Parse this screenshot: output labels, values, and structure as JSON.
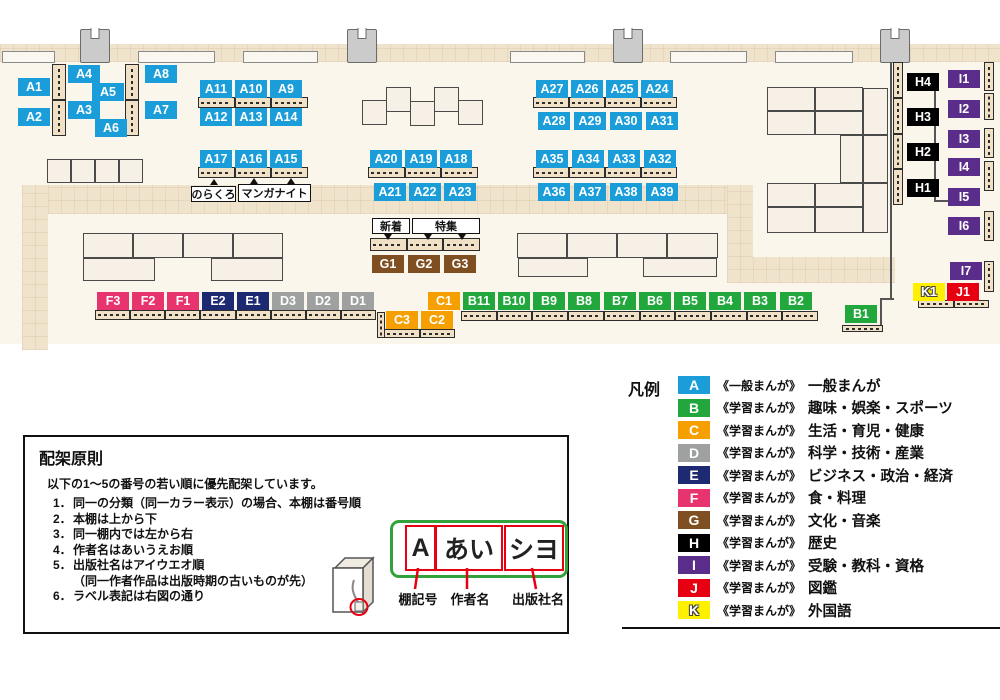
{
  "legend": {
    "title": "凡例",
    "items": [
      {
        "code": "A",
        "color": "#1B9DD9",
        "type": "《一般まんが》",
        "label": "一般まんが"
      },
      {
        "code": "B",
        "color": "#22A73D",
        "type": "《学習まんが》",
        "label": "趣味・娯楽・スポーツ"
      },
      {
        "code": "C",
        "color": "#F5A000",
        "type": "《学習まんが》",
        "label": "生活・育児・健康"
      },
      {
        "code": "D",
        "color": "#9FA0A0",
        "type": "《学習まんが》",
        "label": "科学・技術・産業"
      },
      {
        "code": "E",
        "color": "#1D2A72",
        "type": "《学習まんが》",
        "label": "ビジネス・政治・経済"
      },
      {
        "code": "F",
        "color": "#E7336E",
        "type": "《学習まんが》",
        "label": "食・料理"
      },
      {
        "code": "G",
        "color": "#7F4F21",
        "type": "《学習まんが》",
        "label": "文化・音楽"
      },
      {
        "code": "H",
        "color": "#000000",
        "type": "《学習まんが》",
        "label": "歴史"
      },
      {
        "code": "I",
        "color": "#5A2D8A",
        "type": "《学習まんが》",
        "label": "受験・教科・資格"
      },
      {
        "code": "J",
        "color": "#E60012",
        "type": "《学習まんが》",
        "label": "図鑑"
      },
      {
        "code": "K",
        "color": "#FFF000",
        "type": "《学習まんが》",
        "label": "外国語"
      }
    ]
  },
  "principles": {
    "title": "配架原則",
    "intro": "以下の1～5の番号の若い順に優先配架しています。",
    "rules": [
      {
        "no": "1．",
        "text": "同一の分類（同一カラー表示）の場合、本棚は番号順",
        "indent": false
      },
      {
        "no": "2．",
        "text": "本棚は上から下",
        "indent": false
      },
      {
        "no": "3．",
        "text": "同一棚内では左から右",
        "indent": false
      },
      {
        "no": "4．",
        "text": "作者名はあいうえお順",
        "indent": false
      },
      {
        "no": "5．",
        "text": "出版社名はアイウエオ順",
        "indent": false
      },
      {
        "no": "",
        "text": "（同一作者作品は出版時期の古いものが先）",
        "indent": true
      },
      {
        "no": "6．",
        "text": "ラベル表記は右図の通り",
        "indent": false
      }
    ],
    "label_example": {
      "parts": [
        {
          "text": "A",
          "caption": "棚記号"
        },
        {
          "text": "あい",
          "caption": "作者名"
        },
        {
          "text": "シヨ",
          "caption": "出版社名"
        }
      ]
    }
  },
  "map": {
    "palette": {
      "floor": "#FBF6EC",
      "carpet": "#F0E3CC",
      "shelf": "#F0E1C6",
      "table": "#F6F0E6",
      "wall": "#555555"
    },
    "annotations": [
      {
        "text": "のらくろ",
        "x": 191,
        "y": 186,
        "w": 45,
        "h": 16
      },
      {
        "text": "マンガナイト",
        "x": 238,
        "y": 184,
        "w": 73,
        "h": 18
      },
      {
        "text": "新着",
        "x": 372,
        "y": 218,
        "w": 38,
        "h": 16
      },
      {
        "text": "特集",
        "x": 412,
        "y": 218,
        "w": 68,
        "h": 16
      }
    ],
    "tails": [
      {
        "x": 384,
        "y": 234,
        "dir": "down"
      },
      {
        "x": 424,
        "y": 234,
        "dir": "down"
      },
      {
        "x": 458,
        "y": 234,
        "dir": "down"
      },
      {
        "x": 210,
        "y": 179,
        "dir": "up"
      },
      {
        "x": 250,
        "y": 178,
        "dir": "up"
      },
      {
        "x": 287,
        "y": 178,
        "dir": "up"
      }
    ],
    "labels": [
      {
        "c": "A1",
        "x": 18,
        "y": 78
      },
      {
        "c": "A2",
        "x": 18,
        "y": 108
      },
      {
        "c": "A4",
        "x": 68,
        "y": 65
      },
      {
        "c": "A5",
        "x": 92,
        "y": 83
      },
      {
        "c": "A3",
        "x": 68,
        "y": 101
      },
      {
        "c": "A6",
        "x": 95,
        "y": 119
      },
      {
        "c": "A8",
        "x": 145,
        "y": 65
      },
      {
        "c": "A7",
        "x": 145,
        "y": 101
      },
      {
        "c": "A11",
        "x": 200,
        "y": 80
      },
      {
        "c": "A10",
        "x": 235,
        "y": 80
      },
      {
        "c": "A9",
        "x": 270,
        "y": 80
      },
      {
        "c": "A12",
        "x": 200,
        "y": 108
      },
      {
        "c": "A13",
        "x": 235,
        "y": 108
      },
      {
        "c": "A14",
        "x": 270,
        "y": 108
      },
      {
        "c": "A17",
        "x": 200,
        "y": 150
      },
      {
        "c": "A16",
        "x": 235,
        "y": 150
      },
      {
        "c": "A15",
        "x": 270,
        "y": 150
      },
      {
        "c": "A20",
        "x": 370,
        "y": 150
      },
      {
        "c": "A19",
        "x": 405,
        "y": 150
      },
      {
        "c": "A18",
        "x": 440,
        "y": 150
      },
      {
        "c": "A21",
        "x": 374,
        "y": 183
      },
      {
        "c": "A22",
        "x": 409,
        "y": 183
      },
      {
        "c": "A23",
        "x": 444,
        "y": 183
      },
      {
        "c": "A27",
        "x": 536,
        "y": 80
      },
      {
        "c": "A26",
        "x": 571,
        "y": 80
      },
      {
        "c": "A25",
        "x": 606,
        "y": 80
      },
      {
        "c": "A24",
        "x": 641,
        "y": 80
      },
      {
        "c": "A28",
        "x": 538,
        "y": 112
      },
      {
        "c": "A29",
        "x": 574,
        "y": 112
      },
      {
        "c": "A30",
        "x": 610,
        "y": 112
      },
      {
        "c": "A31",
        "x": 646,
        "y": 112
      },
      {
        "c": "A35",
        "x": 536,
        "y": 150
      },
      {
        "c": "A34",
        "x": 572,
        "y": 150
      },
      {
        "c": "A33",
        "x": 608,
        "y": 150
      },
      {
        "c": "A32",
        "x": 644,
        "y": 150
      },
      {
        "c": "A36",
        "x": 538,
        "y": 183
      },
      {
        "c": "A37",
        "x": 574,
        "y": 183
      },
      {
        "c": "A38",
        "x": 610,
        "y": 183
      },
      {
        "c": "A39",
        "x": 646,
        "y": 183
      },
      {
        "c": "G1",
        "x": 372,
        "y": 255
      },
      {
        "c": "G2",
        "x": 408,
        "y": 255
      },
      {
        "c": "G3",
        "x": 444,
        "y": 255
      },
      {
        "c": "F3",
        "x": 97,
        "y": 292
      },
      {
        "c": "F2",
        "x": 132,
        "y": 292
      },
      {
        "c": "F1",
        "x": 167,
        "y": 292
      },
      {
        "c": "E2",
        "x": 202,
        "y": 292
      },
      {
        "c": "E1",
        "x": 237,
        "y": 292
      },
      {
        "c": "D3",
        "x": 272,
        "y": 292
      },
      {
        "c": "D2",
        "x": 307,
        "y": 292
      },
      {
        "c": "D1",
        "x": 342,
        "y": 292
      },
      {
        "c": "C1",
        "x": 428,
        "y": 292
      },
      {
        "c": "C3",
        "x": 386,
        "y": 311
      },
      {
        "c": "C2",
        "x": 421,
        "y": 311
      },
      {
        "c": "B11",
        "x": 463,
        "y": 292
      },
      {
        "c": "B10",
        "x": 498,
        "y": 292
      },
      {
        "c": "B9",
        "x": 533,
        "y": 292
      },
      {
        "c": "B8",
        "x": 568,
        "y": 292
      },
      {
        "c": "B7",
        "x": 604,
        "y": 292
      },
      {
        "c": "B6",
        "x": 639,
        "y": 292
      },
      {
        "c": "B5",
        "x": 674,
        "y": 292
      },
      {
        "c": "B4",
        "x": 709,
        "y": 292
      },
      {
        "c": "B3",
        "x": 744,
        "y": 292
      },
      {
        "c": "B2",
        "x": 780,
        "y": 292
      },
      {
        "c": "B1",
        "x": 845,
        "y": 305
      },
      {
        "c": "H4",
        "x": 907,
        "y": 73
      },
      {
        "c": "H3",
        "x": 907,
        "y": 108
      },
      {
        "c": "H2",
        "x": 907,
        "y": 143
      },
      {
        "c": "H1",
        "x": 907,
        "y": 179
      },
      {
        "c": "I1",
        "x": 948,
        "y": 70
      },
      {
        "c": "I2",
        "x": 948,
        "y": 100
      },
      {
        "c": "I3",
        "x": 948,
        "y": 130
      },
      {
        "c": "I4",
        "x": 948,
        "y": 158
      },
      {
        "c": "I5",
        "x": 948,
        "y": 188
      },
      {
        "c": "I6",
        "x": 948,
        "y": 217
      },
      {
        "c": "I7",
        "x": 950,
        "y": 262
      },
      {
        "c": "K1",
        "x": 913,
        "y": 283
      },
      {
        "c": "J1",
        "x": 947,
        "y": 283
      }
    ],
    "shelves": [
      {
        "o": "v",
        "x": 52,
        "y": 64,
        "w": 14,
        "h": 72,
        "s": 2
      },
      {
        "o": "v",
        "x": 125,
        "y": 64,
        "w": 14,
        "h": 72,
        "s": 2
      },
      {
        "o": "h",
        "x": 198,
        "y": 97,
        "w": 110,
        "h": 11,
        "s": 3
      },
      {
        "o": "h",
        "x": 198,
        "y": 167,
        "w": 110,
        "h": 11,
        "s": 3
      },
      {
        "o": "h",
        "x": 368,
        "y": 167,
        "w": 110,
        "h": 11,
        "s": 3
      },
      {
        "o": "h",
        "x": 533,
        "y": 97,
        "w": 144,
        "h": 11,
        "s": 4
      },
      {
        "o": "h",
        "x": 533,
        "y": 167,
        "w": 144,
        "h": 11,
        "s": 4
      },
      {
        "o": "h",
        "x": 370,
        "y": 238,
        "w": 110,
        "h": 13,
        "s": 3
      },
      {
        "o": "h",
        "x": 95,
        "y": 310,
        "w": 281,
        "h": 10,
        "s": 8
      },
      {
        "o": "v",
        "x": 377,
        "y": 312,
        "w": 8,
        "h": 26,
        "s": 1
      },
      {
        "o": "h",
        "x": 384,
        "y": 329,
        "w": 71,
        "h": 9,
        "s": 2
      },
      {
        "o": "h",
        "x": 461,
        "y": 311,
        "w": 357,
        "h": 10,
        "s": 10
      },
      {
        "o": "h",
        "x": 842,
        "y": 325,
        "w": 41,
        "h": 7,
        "s": 1
      },
      {
        "o": "h",
        "x": 918,
        "y": 300,
        "w": 71,
        "h": 8,
        "s": 2
      },
      {
        "o": "v",
        "x": 893,
        "y": 62,
        "w": 10,
        "h": 143,
        "s": 4
      },
      {
        "o": "v",
        "x": 984,
        "y": 62,
        "w": 10,
        "h": 29,
        "s": 1
      },
      {
        "o": "v",
        "x": 984,
        "y": 93,
        "w": 10,
        "h": 27,
        "s": 1
      },
      {
        "o": "v",
        "x": 984,
        "y": 128,
        "w": 10,
        "h": 30,
        "s": 1
      },
      {
        "o": "v",
        "x": 984,
        "y": 161,
        "w": 10,
        "h": 30,
        "s": 1
      },
      {
        "o": "v",
        "x": 984,
        "y": 211,
        "w": 10,
        "h": 30,
        "s": 1
      },
      {
        "o": "v",
        "x": 984,
        "y": 261,
        "w": 10,
        "h": 31,
        "s": 1
      }
    ],
    "tables": [
      [
        47,
        159,
        24,
        24
      ],
      [
        71,
        159,
        24,
        24
      ],
      [
        95,
        159,
        24,
        24
      ],
      [
        119,
        159,
        24,
        24
      ],
      [
        362,
        100,
        25,
        25
      ],
      [
        386,
        87,
        25,
        25
      ],
      [
        410,
        101,
        25,
        25
      ],
      [
        434,
        87,
        25,
        25
      ],
      [
        458,
        100,
        25,
        25
      ],
      [
        83,
        233,
        50,
        25
      ],
      [
        133,
        233,
        50,
        25
      ],
      [
        183,
        233,
        50,
        25
      ],
      [
        233,
        233,
        50,
        25
      ],
      [
        83,
        258,
        72,
        23
      ],
      [
        211,
        258,
        72,
        23
      ],
      [
        517,
        233,
        50,
        25
      ],
      [
        567,
        233,
        50,
        25
      ],
      [
        617,
        233,
        50,
        25
      ],
      [
        667,
        233,
        51,
        25
      ],
      [
        518,
        258,
        70,
        19
      ],
      [
        643,
        258,
        74,
        19
      ],
      [
        767,
        87,
        48,
        24
      ],
      [
        815,
        87,
        48,
        24
      ],
      [
        767,
        111,
        48,
        24
      ],
      [
        815,
        111,
        48,
        24
      ],
      [
        863,
        88,
        25,
        47
      ],
      [
        840,
        135,
        23,
        48
      ],
      [
        863,
        135,
        25,
        48
      ],
      [
        767,
        183,
        48,
        24
      ],
      [
        815,
        183,
        48,
        24
      ],
      [
        767,
        207,
        48,
        26
      ],
      [
        815,
        207,
        48,
        26
      ],
      [
        863,
        183,
        25,
        50
      ]
    ],
    "carpets": [
      [
        0,
        44,
        1000,
        18
      ],
      [
        22,
        185,
        731,
        29
      ],
      [
        22,
        185,
        26,
        165
      ],
      [
        727,
        185,
        26,
        98
      ],
      [
        727,
        257,
        168,
        26
      ]
    ],
    "windows": [
      [
        2,
        51,
        53,
        12
      ],
      [
        138,
        51,
        77,
        12
      ],
      [
        243,
        51,
        75,
        12
      ],
      [
        510,
        51,
        75,
        12
      ],
      [
        670,
        51,
        77,
        12
      ],
      [
        775,
        51,
        78,
        12
      ]
    ],
    "pillars": [
      [
        80,
        29
      ],
      [
        347,
        29
      ],
      [
        613,
        29
      ],
      [
        880,
        29
      ]
    ],
    "walls": [
      [
        890,
        62,
        2,
        238
      ],
      [
        880,
        298,
        14,
        2
      ],
      [
        880,
        300,
        2,
        25
      ],
      [
        934,
        80,
        2,
        122
      ],
      [
        934,
        200,
        15,
        2
      ]
    ]
  }
}
